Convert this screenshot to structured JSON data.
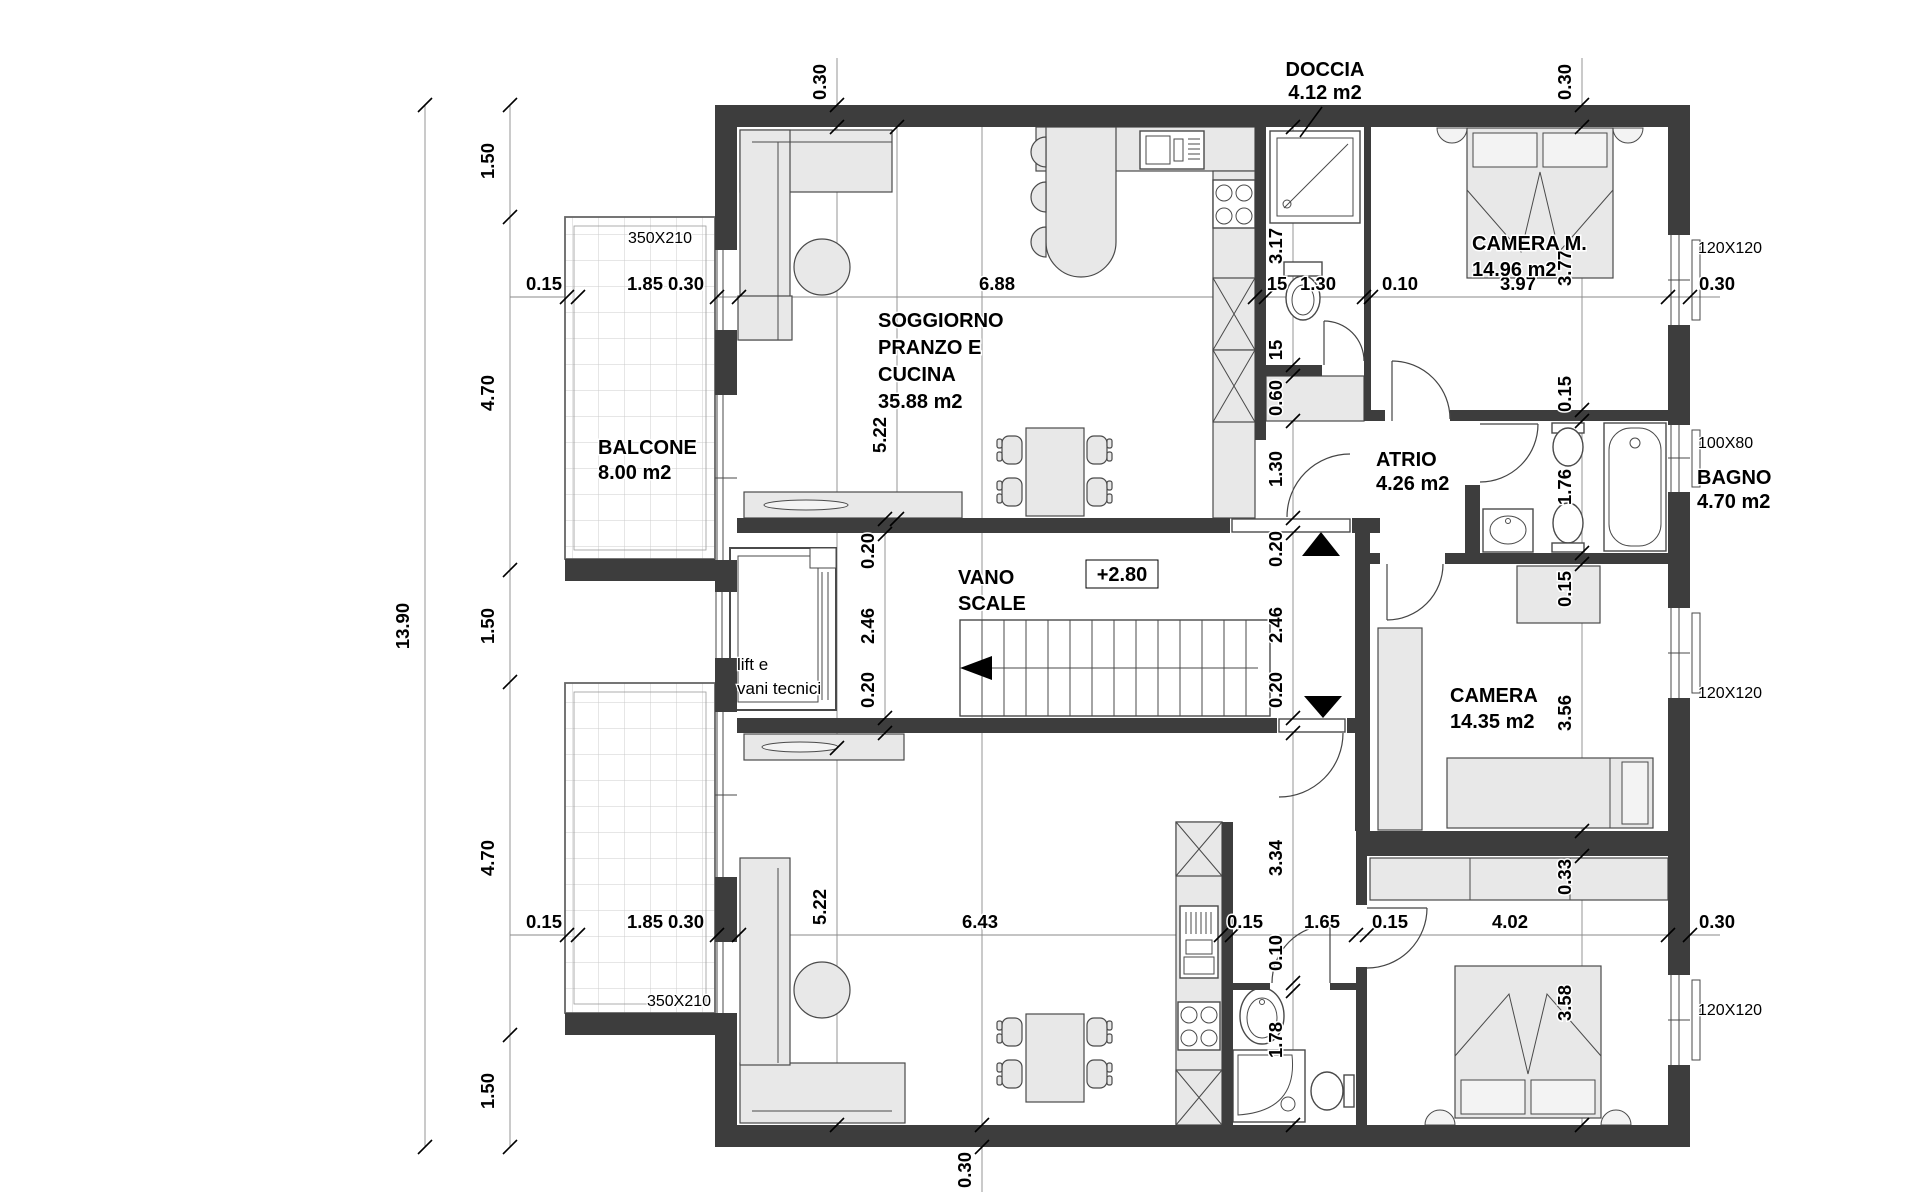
{
  "rooms": {
    "soggiorno": {
      "line1": "SOGGIORNO",
      "line2": "PRANZO E",
      "line3": "CUCINA",
      "area": "35.88 m2"
    },
    "doccia": {
      "name": "DOCCIA",
      "area": "4.12 m2"
    },
    "camera_m": {
      "name": "CAMERA M.",
      "area": "14.96 m2"
    },
    "balcone": {
      "name": "BALCONE",
      "area": "8.00 m2"
    },
    "vano_scale": {
      "line1": "VANO",
      "line2": "SCALE",
      "level": "+2.80"
    },
    "lift": {
      "line1": "lift e",
      "line2": "vani tecnici"
    },
    "atrio": {
      "name": "ATRIO",
      "area": "4.26 m2"
    },
    "bagno": {
      "name": "BAGNO",
      "area": "4.70 m2"
    },
    "camera": {
      "name": "CAMERA",
      "area": "14.35 m2"
    }
  },
  "windows": {
    "balcony_top": "350X210",
    "balcony_bottom": "350X210",
    "camera_m": "120X120",
    "bagno": "100X80",
    "camera": "120X120",
    "camera_bottom": "120X120"
  },
  "dims": {
    "overall_height": "13.90",
    "left_chain": [
      "1.50",
      "4.70",
      "1.50",
      "4.70",
      "1.50"
    ],
    "top_chain": [
      "0.15",
      "1.85",
      "0.30",
      "6.88",
      "15",
      "1.30",
      "0.10",
      "3.97",
      "0.30"
    ],
    "bottom_chain": [
      "0.15",
      "1.85",
      "0.30",
      "6.43",
      "0.15",
      "1.65",
      "0.15",
      "4.02",
      "0.30"
    ],
    "center_chain": [
      "3.17",
      "15",
      "0.60",
      "1.30",
      "0.20",
      "2.46",
      "0.20",
      "3.34",
      "0.10",
      "1.78"
    ],
    "stair_chain": [
      "0.20",
      "2.46",
      "0.20"
    ],
    "right_chain": [
      "3.77",
      "0.15",
      "1.76",
      "0.15",
      "3.56",
      "0.33",
      "3.58"
    ],
    "soggiorno_depth_top": "5.22",
    "soggiorno_depth_bottom": "5.22",
    "wall_top_left": "0.30",
    "wall_top_right": "0.30",
    "wall_bottom": "0.30"
  }
}
